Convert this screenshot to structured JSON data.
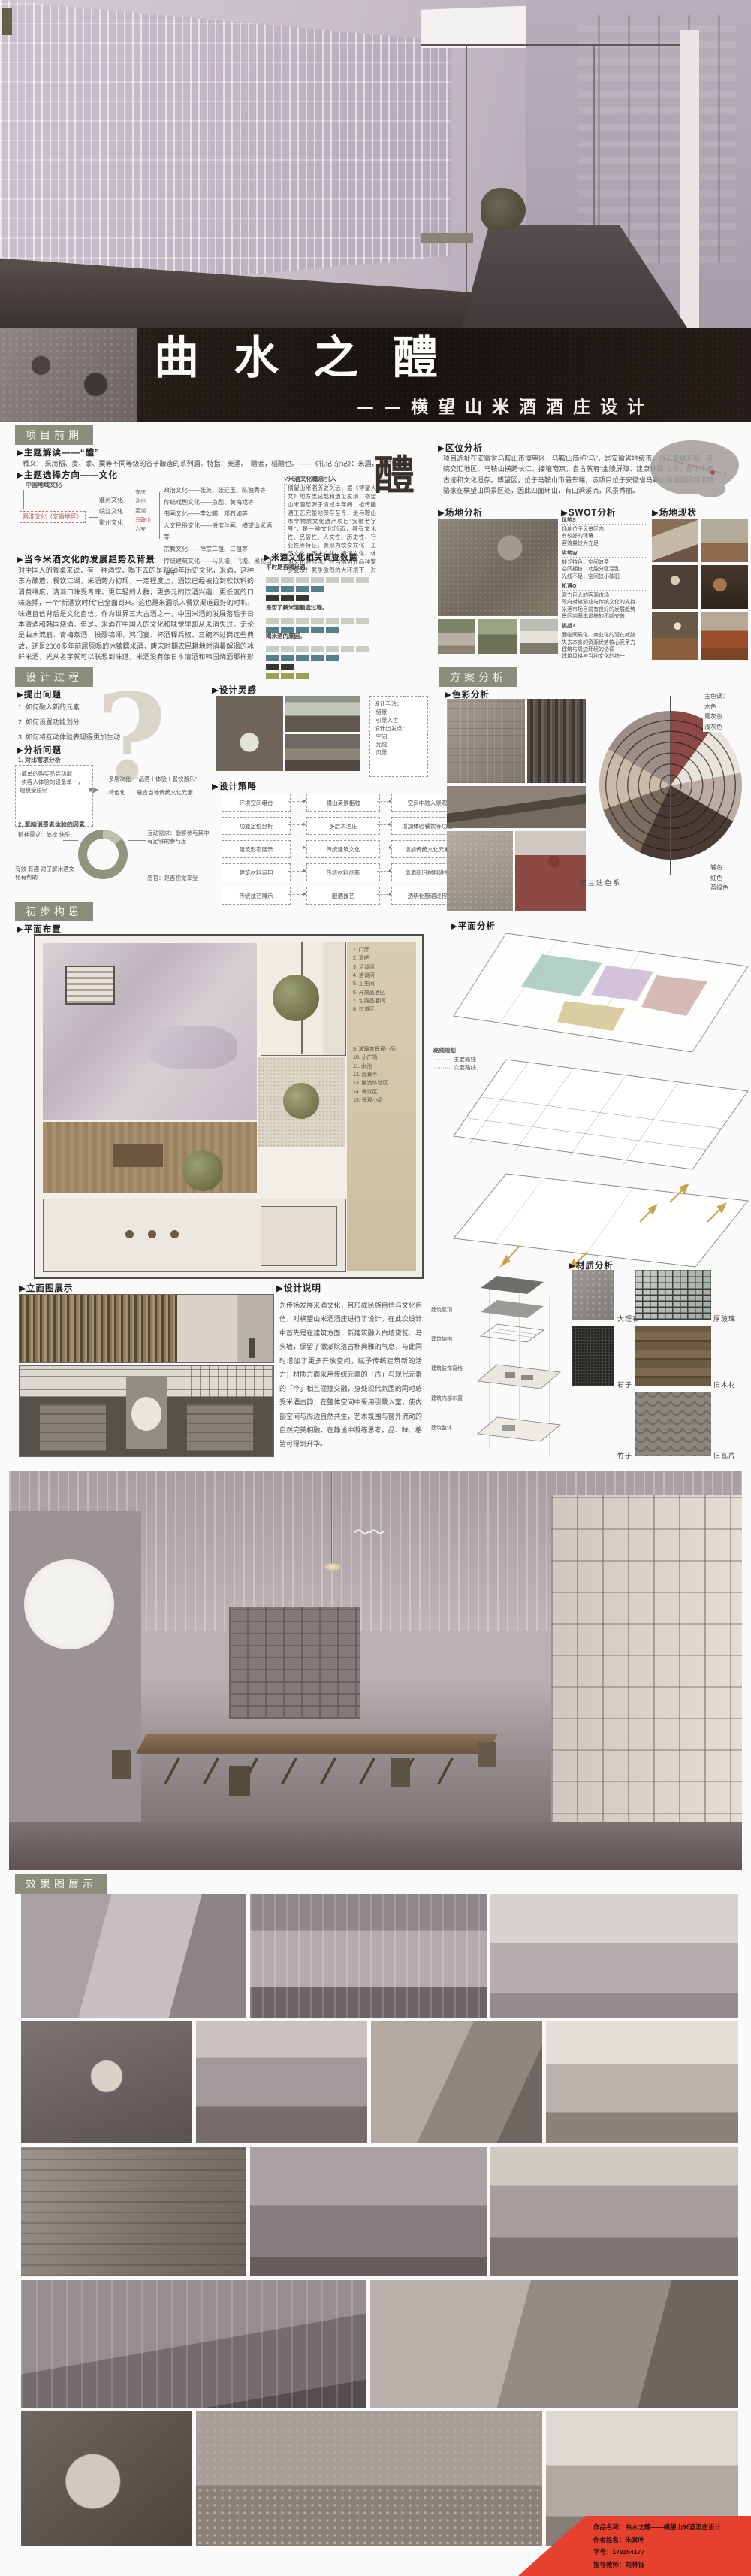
{
  "poster": {
    "title": "曲水之醴",
    "subtitle": "——横望山米酒酒庄设计",
    "colors": {
      "header_bg": "#8b8d7a",
      "accent_red": "#b85c55",
      "banner_red": "#e6402e"
    }
  },
  "s1": {
    "header": "项目前期",
    "h_theme": "▶主题解读——“醴”",
    "theme_text": "释义： 采用稻、麦、黍、粟等不同等级的谷子酿造的系列酒。特指：美酒。　醴者，稻醴也。——《礼记·杂记》：米酒，旧时叫“醴”",
    "h_direction": "▶主题选择方向——文化",
    "tree": {
      "root": "中国地域文化",
      "region": "两淮文化（安徽地区）",
      "cultures": [
        "淮河文化",
        "皖江文化",
        "徽州文化"
      ],
      "cities": [
        "安庆",
        "池州",
        "芜湖",
        "马鞍山",
        "六安"
      ],
      "branches": [
        "政治文化——张英、张廷玉、陈独秀等",
        "传统戏剧文化——京剧、黄梅戏等",
        "书画文化——李公麟、邓石如等",
        "人文民俗文化——洪滨丝画、横望山米酒等",
        "宗教文化——禅宗二祖、三祖等",
        "传统建筑文化——马头墙、飞檐、黑瓦白墙等"
      ]
    },
    "glyph": "醴",
    "h_intro": "∵米酒文化概念引入",
    "intro_text": "横望山米酒历史久远，据《博望人文》地方志记载和遗址发现，横望山米酒起源于清咸丰年间，祖传酿酒工艺完整地保存至今，是马鞍山市非物质文化遗产项目“安徽老字号”，是一种文化形态，具有文化性、民俗性、人文性、历史性、行业性等特征，表现为饮食文化、工艺文化、历史文化、诗词文化、休闲文化等形态。在当前酒业品种繁多复杂、竞争激烈的大环境下，对米酒文化的传承、创新、保护和利用，使中国的传统原生文化烟煴生辉，形成新时代文化自信。",
    "h_trend": "▶当今米酒文化的发展趋势及背景",
    "trend_text": "对中国人的餐桌来说，有一种酒饮，喝下去的是7000年历史文化，米酒，这种东方酿造，餐饮江湖，米酒势力初现，一定程度上，酒饮已经被拉到软饮料的消费维度，清淡口味受青睐。更年轻的人群，更多元的饮酒兴趣、更低度的口味选择，一个“新酒饮时代”已全面到来。这也是米酒杀入餐饮渠道最好的时机，味道自信背后是文化自信。作为世界三大古酒之一，中国米酒的发展落后于日本清酒和韩国烧酒。但是，米酒在中国人的文化和味觉里却从未消失过。无论是曲水流觞、青梅煮酒、投醪犒师、鸿门宴、杯酒释兵权、三碗不过岗这些典故，还是2000多年前屈原喝的冰镇糯米酒，唐宋时期农民耕地时消暑解渴的冰鲜米酒，光从名字就可以联想到味道。米酒没有像日本清酒和韩国烧酒那样形成强势文化，有很大一部分原因在于中国文化的长期弱势。我们的文明、文化在百年以来一直都是弱势文明、弱势文化，没有话语权。但随着国力增强和如今新时代消费者崛起，这群自带民族自信和文化自豪的一代人，会让米酒文化传扬发展。",
    "h_survey": "▶米酒文化相关调查数据",
    "survey_colors": {
      "g": "#c9cdc2",
      "t": "#53808d",
      "d": "#36362f",
      "o": "#9aa052"
    },
    "survey": [
      {
        "q": "平时是否喝米酒。",
        "rows": [
          [
            "g",
            7
          ],
          [
            "t",
            4
          ],
          [
            "d",
            3
          ]
        ]
      },
      {
        "q": "是否了解米酒酿造过程。",
        "rows": [
          [
            "g",
            7
          ],
          [
            "t",
            5
          ]
        ]
      },
      {
        "q": "喝米酒的原因。",
        "rows": [
          [
            "g",
            7
          ],
          [
            "t",
            5
          ],
          [
            "d",
            2
          ],
          [
            "o",
            3
          ]
        ]
      }
    ],
    "h_location": "▶区位分析",
    "location_text": "项目选址在安徽省马鞍山市博望区，马鞍山简称“马”，是安徽省地级市，位于安徽东部、苏皖交汇地区。马鞍山横跨长江、接壤南京，自古就有“金陵屏障、建康锁钥”之称，留下众多古迹和文化遗存。博望区，位于马鞍山市最东端，该项目位于安徽省马鞍山市博望区新市镇骆家在横望山风景区处，因此四面环山，有山涧溪流，风景秀丽。",
    "h_site": "▶场地分析",
    "h_swot": "▶SWOT分析",
    "swot": [
      {
        "k": "优势S",
        "items": [
          "场地位于风景区内",
          "有较好的环境",
          "客流量较为充足"
        ]
      },
      {
        "k": "劣势W",
        "items": [
          "缺乏特色，空间浪费",
          "空间拥挤，功能分区混乱",
          "光线不足，空间狭小破旧"
        ]
      },
      {
        "k": "机遇O",
        "items": [
          "潜力巨大的客源市场",
          "政府对旅游业与传统文化的支持",
          "米酒市场目前有良好的发展趋势",
          "景区内基本设施的不断完善"
        ]
      },
      {
        "k": "挑战T",
        "items": [
          "面临同质化、商业化的潜在威胁",
          "失去本身的资源优势核心竞争力",
          "建筑与周边环境的协调",
          "建筑风格与当地文化的统一"
        ]
      }
    ],
    "h_status": "▶场地现状"
  },
  "s2": {
    "header": "设计过程",
    "h_questions": "▶提出问题",
    "questions": [
      "1. 如何融入新的元素",
      "2. 如何设置功能划分",
      "3. 如何将互动体验表现得更加生动"
    ],
    "h_analysis": "▶分析问题",
    "analysis1": "1. 对比需求分析",
    "box_now": [
      "·简单的购买品尝功能",
      "·供客人体验的设备单一，规模受限制"
    ],
    "box_goal": [
      "·多层次化　“品酒＋体验＋餐饮游乐”",
      "·特色化　　融合当地传统文化元素"
    ],
    "analysis2": "2. 影响消费者体验的因素",
    "donut_labels": [
      "精神需求：放松 快乐",
      "有效 有趣 对了解米酒文化有帮助",
      "互动需求：能够参与其中 有足够的参与度",
      "感官：是否视觉享受"
    ],
    "h_inspiration": "▶设计灵感",
    "inspiration_note": [
      "设计手法：",
      "·借景",
      "·引景入世",
      "设计出发点：",
      "·空间",
      "·光线",
      "·风景"
    ],
    "h_strategy": "▶设计策略",
    "strategy": [
      {
        "a": "环境空间组合",
        "b": "横山美景相融",
        "c": "空间中融入景观"
      },
      {
        "a": "功能定位分析",
        "b": "多层次酒庄",
        "c": "增加体验餐饮等功能"
      },
      {
        "a": "建筑形态展示",
        "b": "传统建筑文化",
        "c": "增加传统文化元素"
      },
      {
        "a": "建筑材料运用",
        "b": "传统材料创新",
        "c": "增添新旧材料碰撞"
      },
      {
        "a": "传统技艺展示",
        "b": "酿酒技艺",
        "c": "透明化酿酒过程"
      }
    ]
  },
  "s3": {
    "header": "方案分析",
    "h_color": "▶色彩分析",
    "palette_main": [
      "主色调：",
      "木色",
      "青灰色",
      "浅灰色"
    ],
    "palette_aux": [
      "辅色：",
      "红色",
      "蓝绿色"
    ],
    "palette_caption": "莫兰迪色系"
  },
  "s4": {
    "header": "初步构思",
    "h_plan": "▶平面布置",
    "h_plan_analysis": "▶平面分析",
    "legend_a": [
      "1. 门厅",
      "2. 清吧",
      "3. 洽谈间",
      "4. 洽谈间",
      "5. 卫生间",
      "6. 开放品酒区",
      "7. 包厢品酒间",
      "8. 过道区"
    ],
    "legend_b": [
      "9. 玻璃盒景观小品",
      "10. 小广场",
      "11. 水池",
      "12. 观景亭",
      "13. 酿造体验区",
      "14. 餐饮区",
      "15. 景观小品"
    ],
    "route_title": "路线规划",
    "routes": [
      "·········· 主要路线",
      "·········· 次要路线"
    ]
  },
  "s5": {
    "h_elevation": "▶立面图展示",
    "h_description": "▶设计说明",
    "description": "为传扬发展米酒文化，且形成民族自信与文化自信，对横望山米酒酒庄进行了设计。在此次设计中首先是在建筑方面，新建筑融入白墙黛瓦、马头墙，保留了徽派院落古朴典雅的气息，与此同时增加了更多开放空间，赋予传统建筑新的活力；材质方面采用传统元素的「古」与现代元素的「今」相互碰撞交融，身处现代氛围的同时感受米酒古韵；在整体空间中采用引景入室，使内部空间与周边自然共生，艺术氛围与窗外流动的自然完美相融，在静谧中凝练思考，品、味、格皆可得到升华。",
    "structure_labels": [
      "建筑屋顶",
      "建筑结构",
      "建筑装饰窗格",
      "建筑内部布置",
      "建筑整体"
    ],
    "h_material": "▶材质分析",
    "materials": [
      "大理石",
      "厚玻璃",
      "石子",
      "旧木材",
      "竹子",
      "旧瓦片"
    ]
  },
  "s6": {
    "header": "效果图展示"
  },
  "footer": {
    "work": "作品名称：曲水之醴——横望山米酒酒庄设计",
    "author": "作者姓名：朱赏叶",
    "student_id": "学号：179154177",
    "advisor": "指导教师：刘林钰"
  }
}
